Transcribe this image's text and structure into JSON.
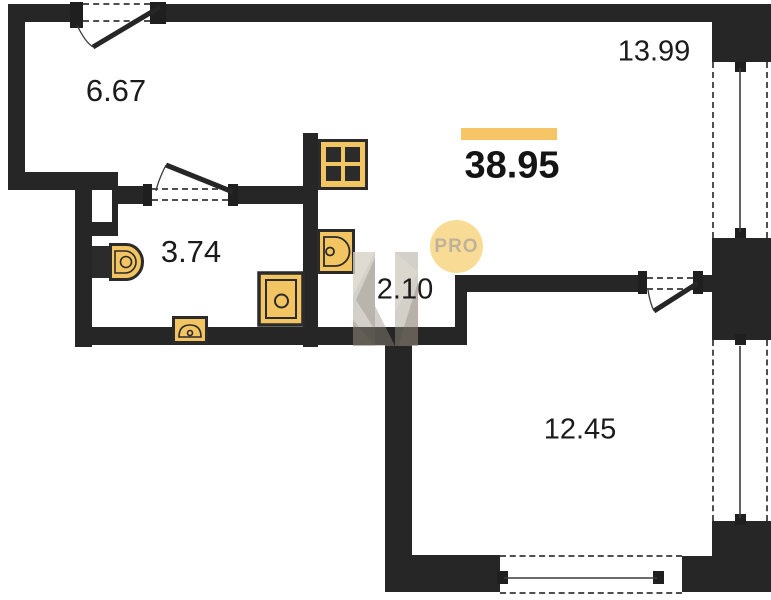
{
  "room_areas": {
    "entry_hall": "6.67",
    "kitchen_living": "13.99",
    "bathroom": "3.74",
    "corridor": "2.10",
    "bedroom": "12.45"
  },
  "total_area": "38.95",
  "badge": {
    "label": "PRO"
  },
  "colors": {
    "wall": "#262626",
    "fixture": "#F2C462",
    "accent_bar": "#F6C566",
    "badge_bg": "#F8DC96",
    "badge_text": "#C0B29A"
  }
}
